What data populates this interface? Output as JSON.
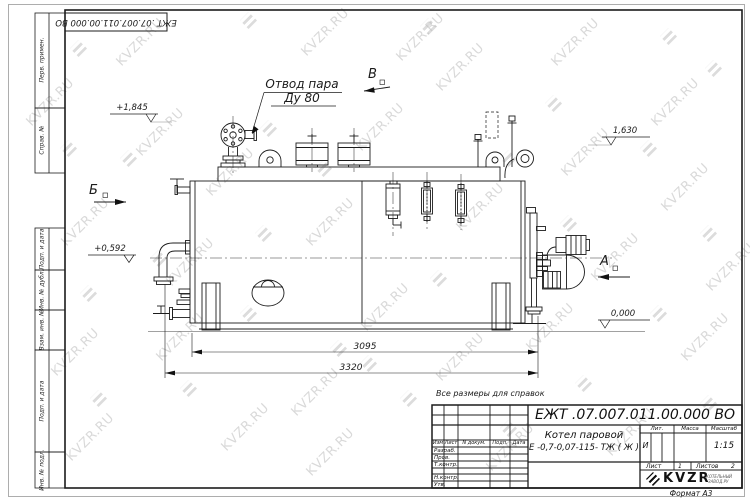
{
  "watermark": {
    "text": "KVZR.RU"
  },
  "stamp_top": {
    "doc_number": "ЕЖТ .07.007.011.00.000  ВО"
  },
  "drawing": {
    "labels": {
      "steam_outlet_line1": "Отвод пара",
      "steam_outlet_line2": "Ду 80"
    },
    "view_markers": {
      "a": "А",
      "b": "Б",
      "v": "В"
    },
    "levels": {
      "l1845": "+1,845",
      "l1630": "1,630",
      "l0592": "+0,592",
      "l0000": "0,000"
    },
    "dimensions": {
      "d3095": "3095",
      "d3320": "3320"
    },
    "note": "Все размеры для справок"
  },
  "side_columns": {
    "items": [
      {
        "label": "Перв. примен."
      },
      {
        "label": "Справ. №"
      },
      {
        "label": "Подп. и дата"
      },
      {
        "label": "Инв. № дубл."
      },
      {
        "label": "Взам. инв. №"
      },
      {
        "label": "Подп. и дата"
      },
      {
        "label": "Инв. № подл."
      }
    ]
  },
  "title_block": {
    "doc_number": "ЕЖТ .07.007.011.00.000  ВО",
    "product_name_line1": "Котел паровой",
    "product_name_line2": "Е -0,7-0,07-115- ТЖ ( Ж )",
    "header_cells": {
      "izm": "Изм",
      "list": "Лист",
      "n_dokum": "N докум.",
      "podp": "Подп.",
      "data": "Дата"
    },
    "rows": [
      {
        "label": "Разраб."
      },
      {
        "label": "Пров."
      },
      {
        "label": "Т.контр."
      },
      {
        "label": ""
      },
      {
        "label": "Н.контр."
      },
      {
        "label": "Утв."
      }
    ],
    "lit_header": "Лит.",
    "massa_header": "Масса",
    "masshtab_header": "Масштаб",
    "lit_value": "И",
    "scale_value": "1:15",
    "sheet_label": "Лист",
    "sheet_value": "1",
    "sheets_label": "Листов",
    "sheets_value": "2",
    "company": "KVZR",
    "company_sub1": "КОТЕЛЬНЫЙ",
    "company_sub2": "ЗАВОД.РУ",
    "format_label": "Формат А3"
  }
}
